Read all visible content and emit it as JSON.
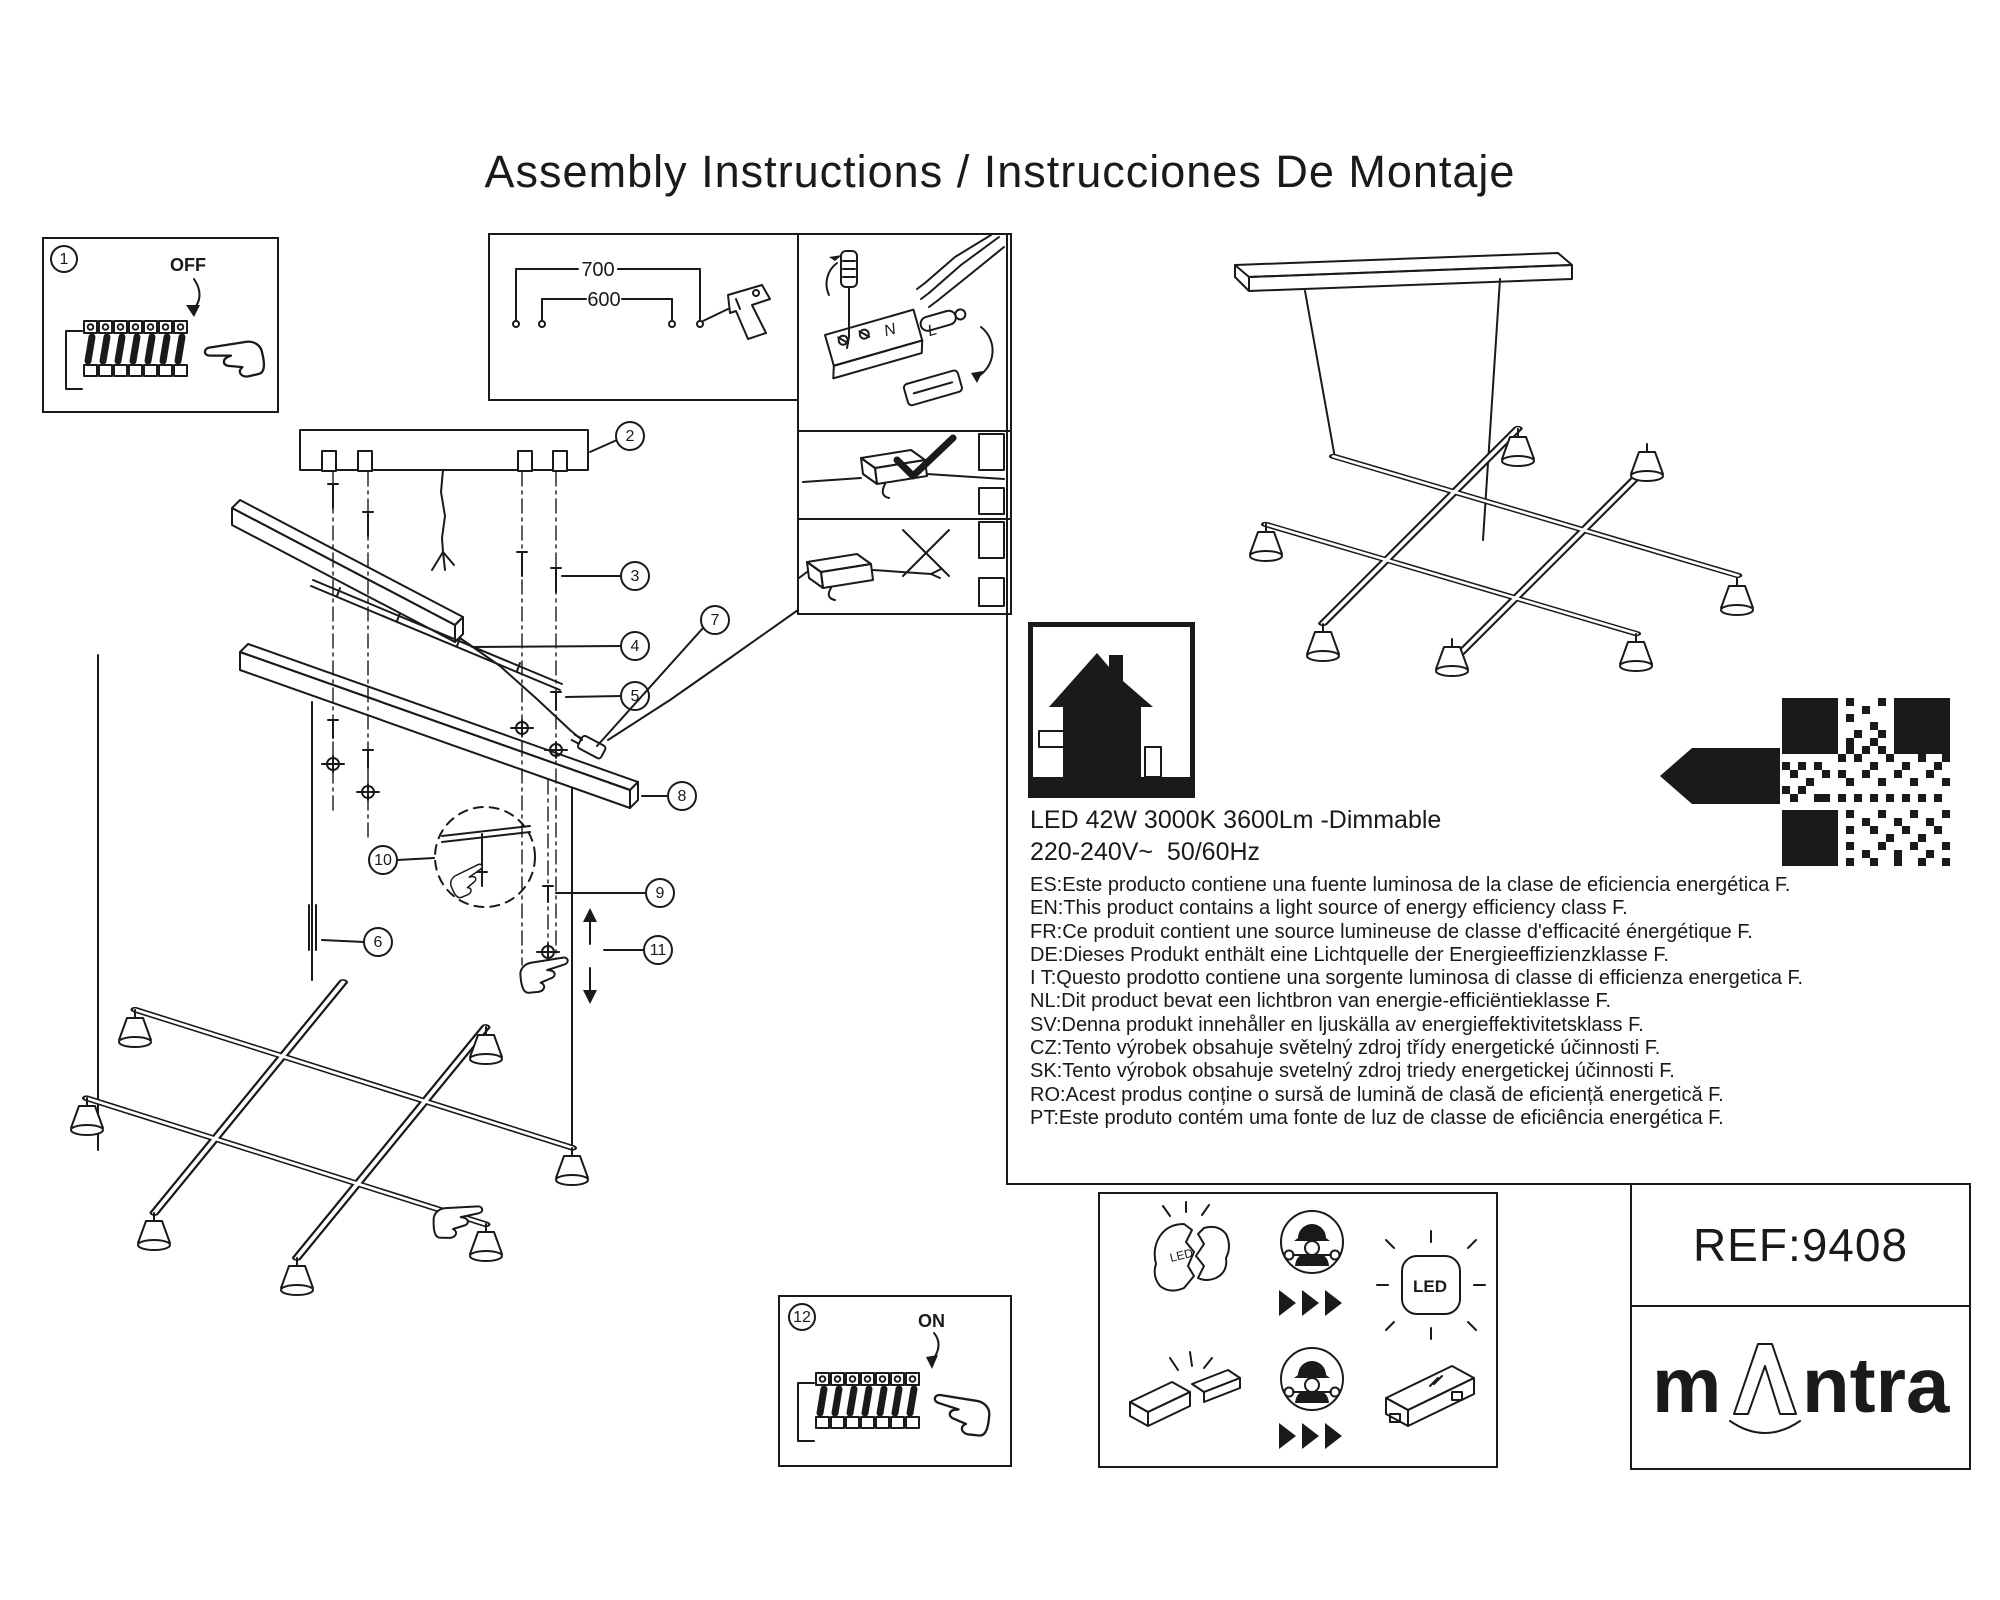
{
  "page": {
    "title": "Assembly Instructions / Instrucciones De Montaje"
  },
  "callouts": {
    "c1": "1",
    "c2": "2",
    "c3": "3",
    "c4": "4",
    "c5": "5",
    "c6": "6",
    "c7": "7",
    "c8": "8",
    "c9": "9",
    "c10": "10",
    "c11": "11",
    "c12": "12"
  },
  "labels": {
    "off": "OFF",
    "on": "ON",
    "d700": "700",
    "d600": "600",
    "n": "N",
    "l": "L",
    "led": "LED",
    "led_broken": "LED"
  },
  "specs": {
    "line1": "LED 42W 3000K 3600Lm -Dimmable",
    "line2": "220-240V~  50/60Hz"
  },
  "energy_notes": [
    "ES:Este producto contiene una fuente luminosa de la clase de eficiencia energética F.",
    "EN:This product contains a light source of energy efficiency class F.",
    "FR:Ce produit contient une source lumineuse de classe d'efficacité énergétique F.",
    "DE:Dieses Produkt enthält eine Lichtquelle der Energieeffizienzklasse F.",
    "I T:Questo prodotto contiene una sorgente luminosa di classe di efficienza energetica F.",
    "NL:Dit product bevat een lichtbron van energie-efficiëntieklasse F.",
    "SV:Denna produkt innehåller en ljuskälla av energieffektivitetsklass F.",
    "CZ:Tento výrobek obsahuje světelný zdroj třídy energetické účinnosti F.",
    "SK:Tento výrobok obsahuje svetelný zdroj triedy energetickej účinnosti F.",
    "RO:Acest produs conține o sursă de lumină de clasă de eficiență energetică F.",
    "PT:Este produto contém uma fonte de luz de classe de eficiência energética F."
  ],
  "energy_label": {
    "class_letter": "F"
  },
  "footer": {
    "ref": "REF:9408",
    "brand_m": "m",
    "brand_ntra": "ntra"
  },
  "icons": {
    "breaker_off": "circuit-breaker-off-icon",
    "breaker_on": "circuit-breaker-on-icon",
    "drill": "drill-icon",
    "screwdriver": "screwdriver-icon",
    "check": "check-icon",
    "cross": "cross-icon",
    "indoor_use": "house-indoor-use-icon",
    "qr": "qr-code",
    "energy_arrow": "energy-class-arrow-icon",
    "technician": "qualified-technician-icon",
    "broken_led": "broken-led-icon",
    "glowing_led": "led-light-source-icon",
    "broken_driver": "broken-driver-icon",
    "driver": "led-driver-icon"
  },
  "colors": {
    "ink": "#1a1a1a",
    "brand_green": "#b5ce1e"
  }
}
